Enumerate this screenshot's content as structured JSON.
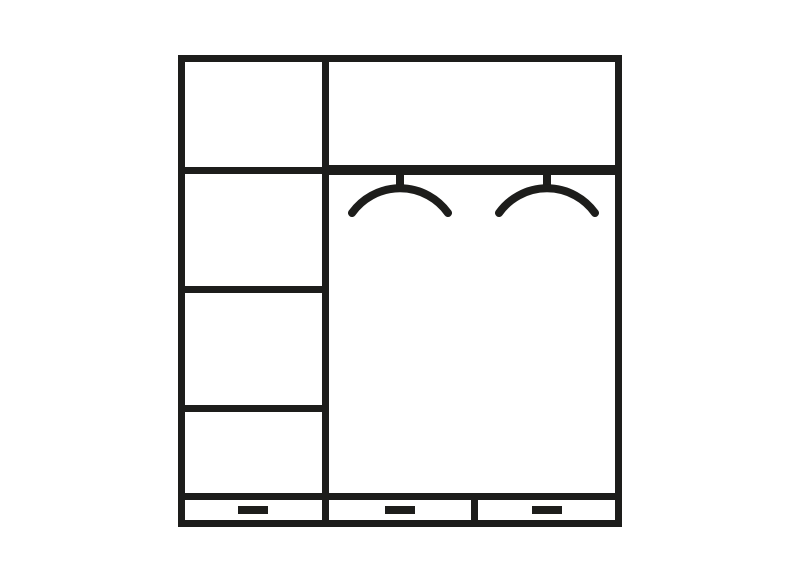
{
  "schematic": {
    "label": "Wardrobe interior layout diagram",
    "colors": {
      "line": "#1d1d1b",
      "background": "#ffffff"
    },
    "left_column": {
      "shelf_lines": 3,
      "compartments": 4
    },
    "right_section": {
      "top_compartments": 1,
      "hanging_rail": 1,
      "hangers": 2
    },
    "drawer_row": {
      "drawers": 3,
      "handles": 3
    }
  }
}
